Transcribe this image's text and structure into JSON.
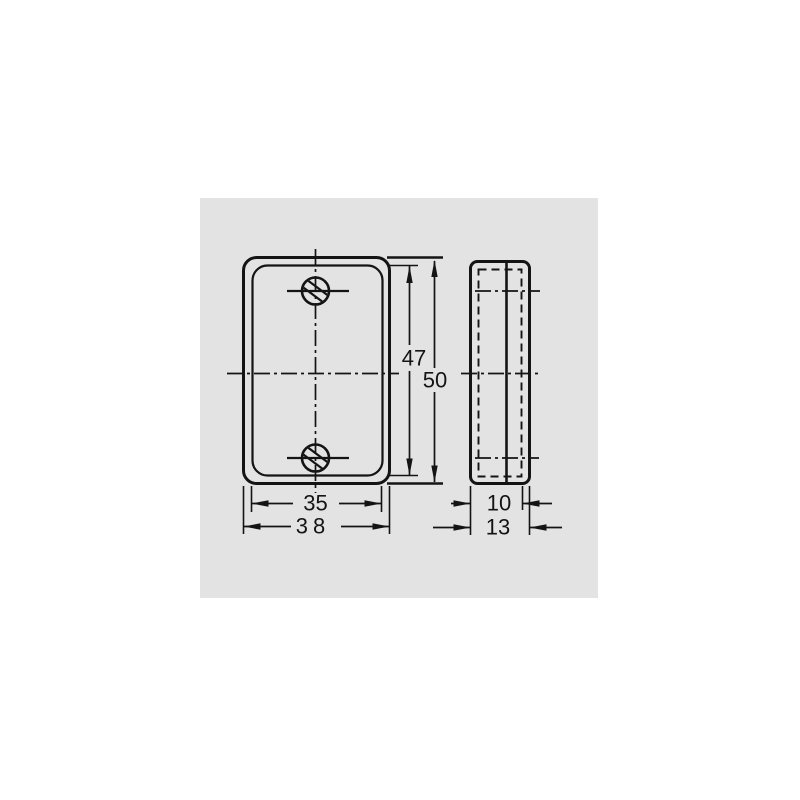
{
  "colors": {
    "page_bg": "#ffffff",
    "panel_bg": "#e3e3e3",
    "line": "#141414"
  },
  "drawing": {
    "type": "technical-drawing",
    "views": {
      "front": {
        "description": "rounded rectangular plate, two countersunk holes on vertical centerline",
        "hole_count": "2",
        "dims": {
          "inner_width": "35",
          "outer_width": "38",
          "inner_height": "47",
          "outer_height": "50"
        }
      },
      "side": {
        "description": "plate profile with hidden inner contour",
        "dims": {
          "inner_thickness": "10",
          "outer_thickness": "13"
        }
      }
    }
  }
}
